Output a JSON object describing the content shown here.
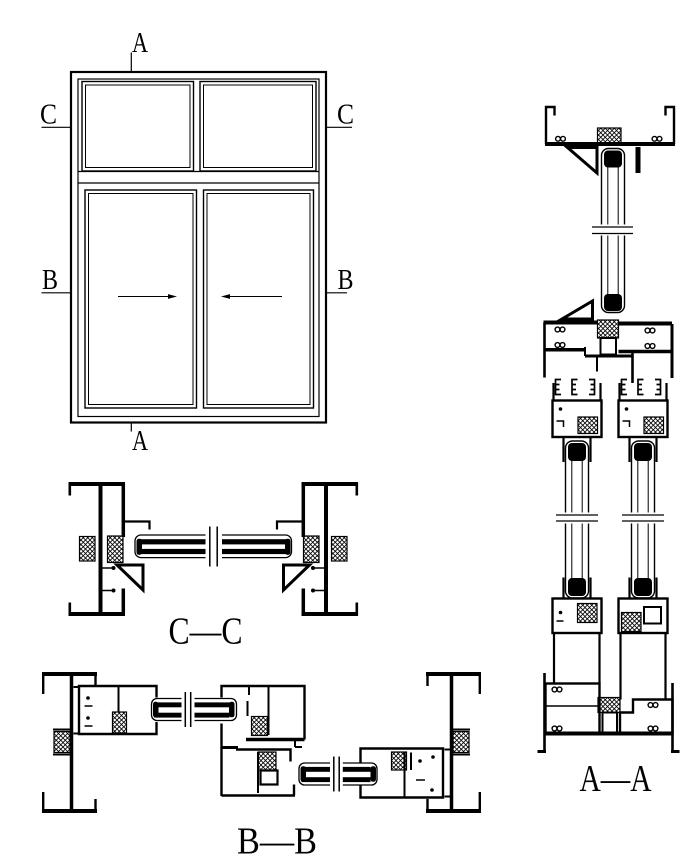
{
  "colors": {
    "ink": "#000000",
    "paper": "#ffffff"
  },
  "elevation": {
    "marks": {
      "top": "A",
      "bottom": "A",
      "left_upper": "C",
      "right_upper": "C",
      "left_middle": "B",
      "right_middle": "B"
    }
  },
  "sections": {
    "cc": {
      "title": "C—C"
    },
    "bb": {
      "title": "B—B"
    },
    "aa": {
      "title": "A—A"
    }
  }
}
